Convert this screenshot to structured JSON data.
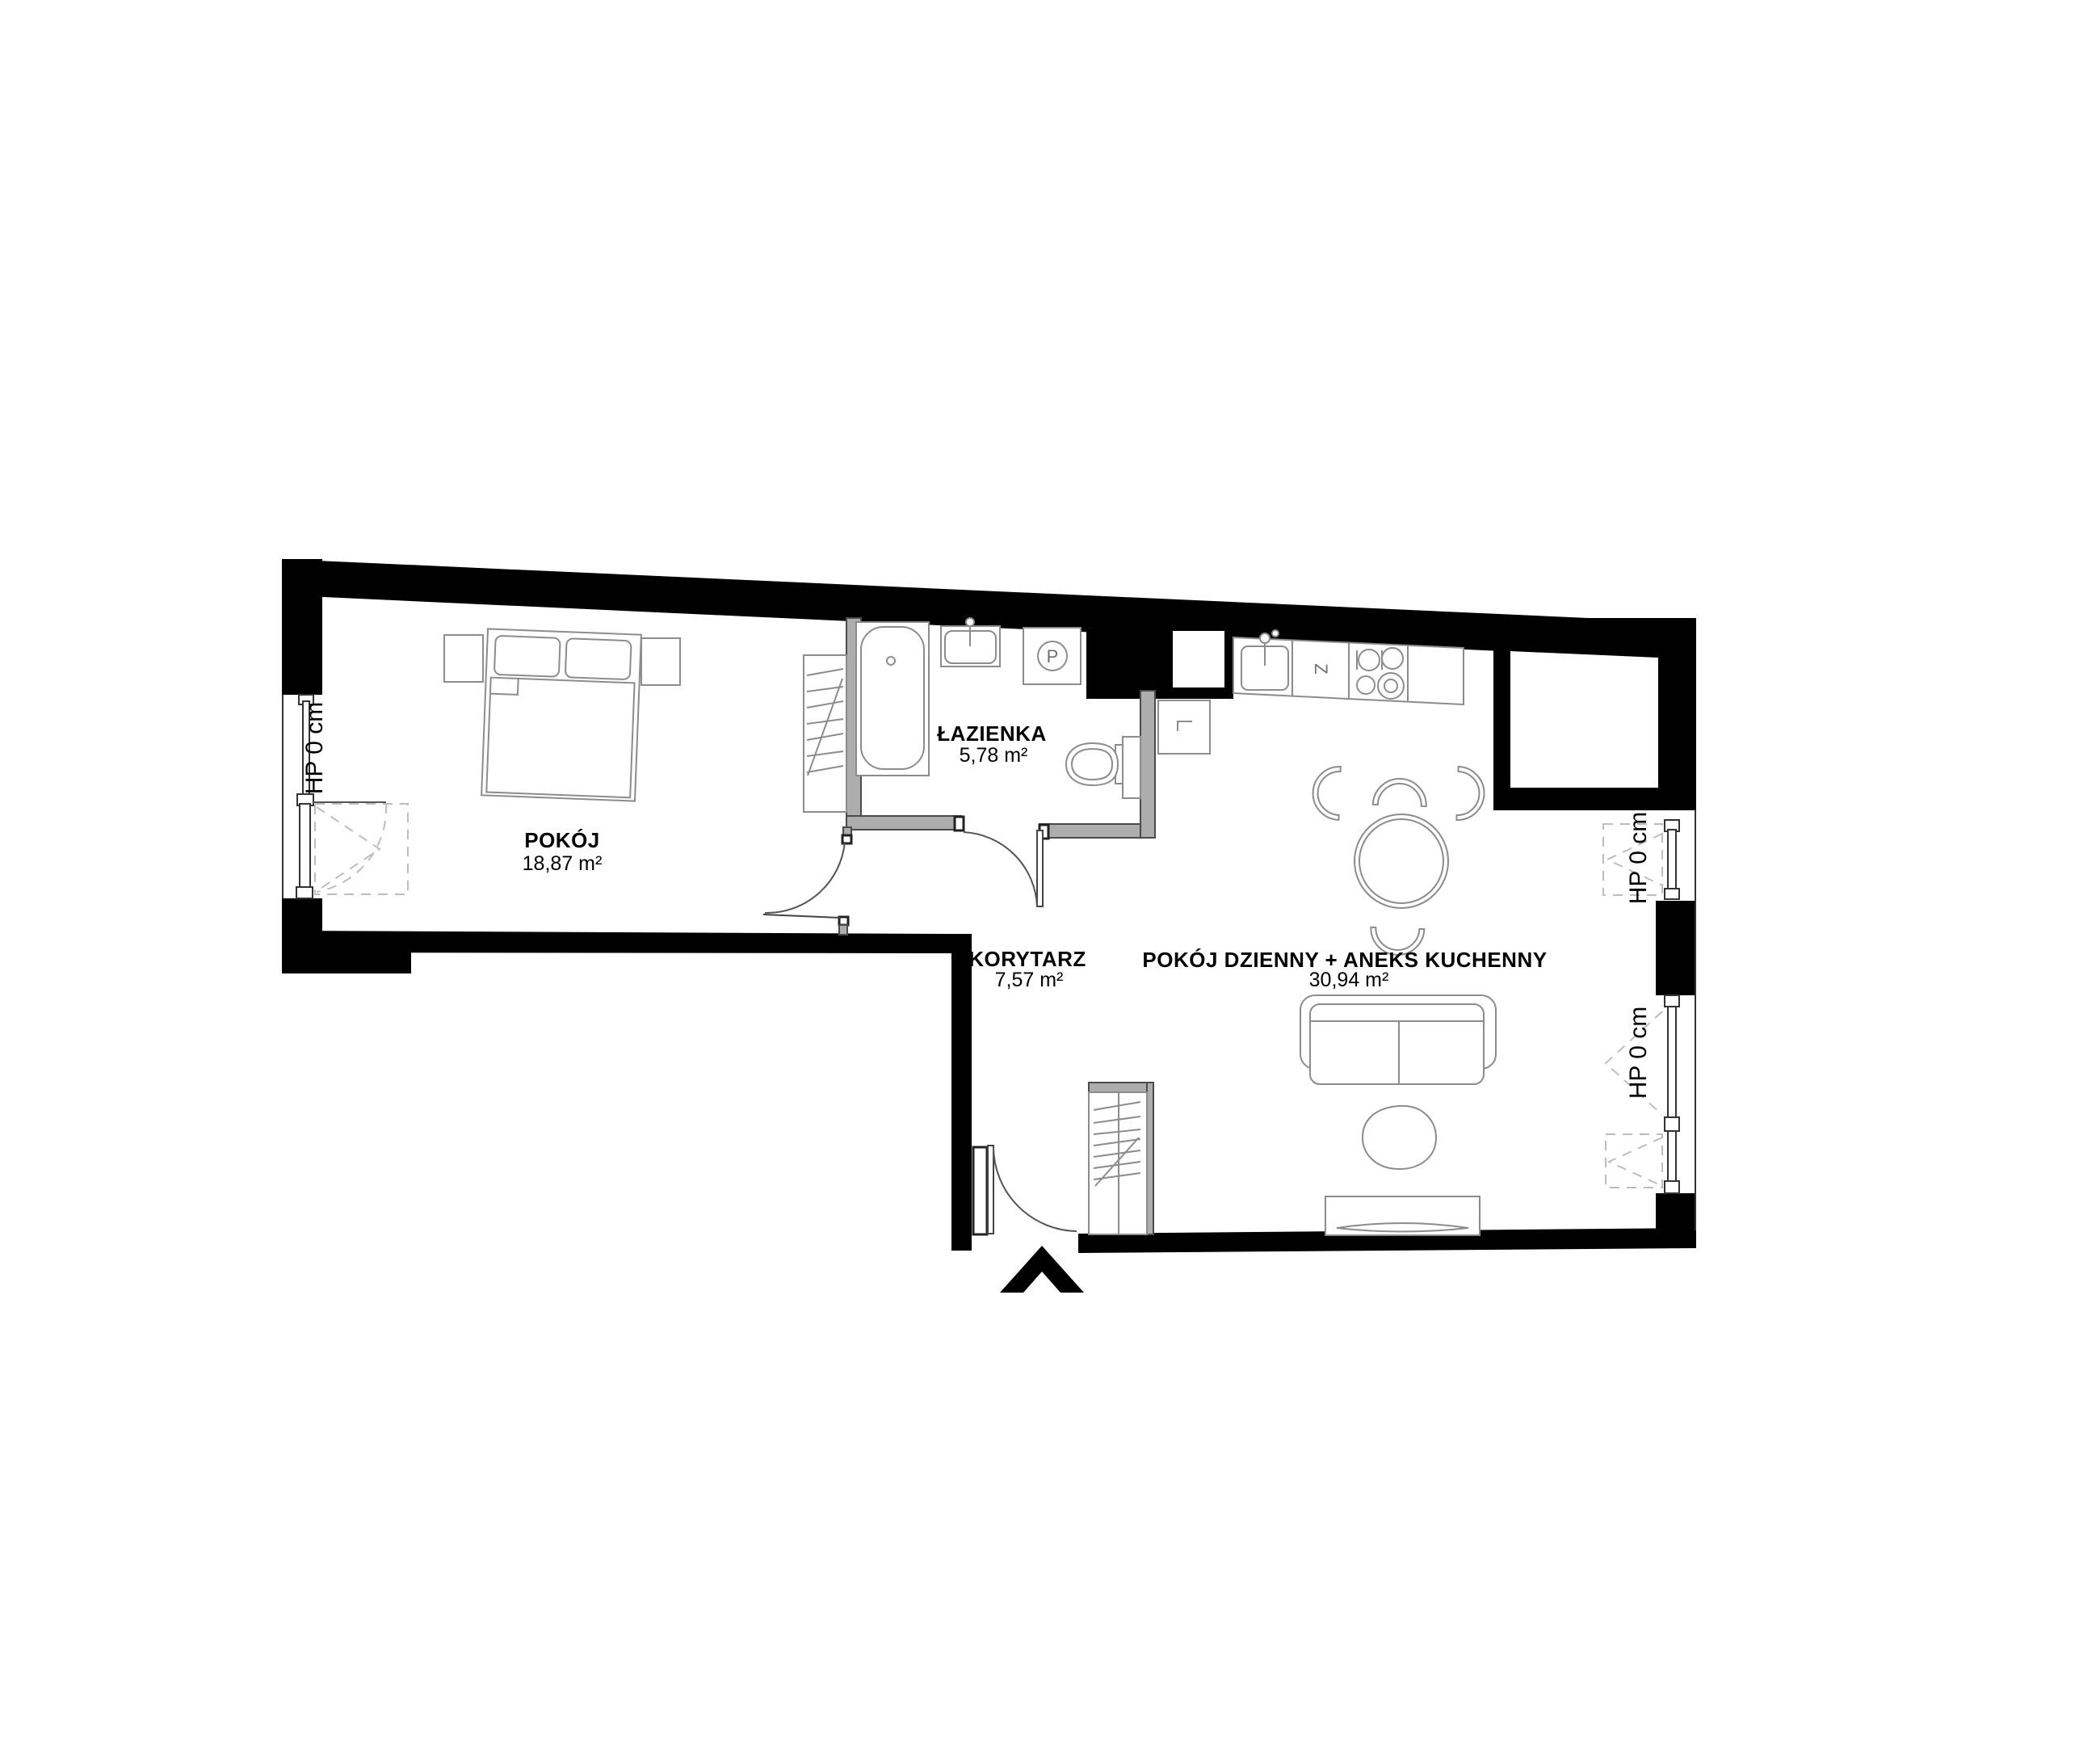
{
  "plan": {
    "rooms": [
      {
        "key": "pokoj",
        "name": "POKÓJ",
        "area": "18,87 m²"
      },
      {
        "key": "lazienka",
        "name": "ŁAZIENKA",
        "area": "5,78 m²"
      },
      {
        "key": "korytarz",
        "name": "KORYTARZ",
        "area": "7,57 m²"
      },
      {
        "key": "salon",
        "name": "POKÓJ DZIENNY + ANEKS KUCHENNY",
        "area": "30,94 m²"
      }
    ],
    "window_sill_labels": {
      "left_window": "HP 0 cm",
      "right_upper_window": "HP 0 cm",
      "right_lower_window": "HP 0 cm"
    },
    "appliance_symbols": {
      "washing_machine": "P",
      "dishwasher": "Z"
    },
    "icons": {
      "entrance_marker": "chevron-up",
      "level_marker": "corner-bracket"
    },
    "colors": {
      "wall": "#000000",
      "partition": "#adadad",
      "outline": "#4b4b4b",
      "furniture_line": "#8c8c8c",
      "dashed_line": "#bdbdbd"
    }
  }
}
